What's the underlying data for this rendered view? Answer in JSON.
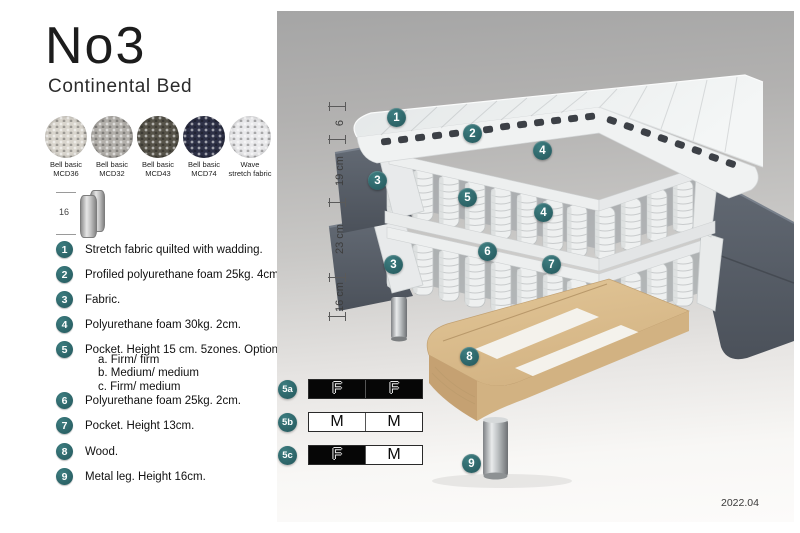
{
  "header": {
    "title": "No3",
    "subtitle": "Continental Bed"
  },
  "swatches": {
    "items": [
      {
        "line1": "Bell basic",
        "line2": "MCD36",
        "color": "#d9d5cd"
      },
      {
        "line1": "Bell basic",
        "line2": "MCD32",
        "color": "#b2afaa"
      },
      {
        "line1": "Bell basic",
        "line2": "MCD43",
        "color": "#565349"
      },
      {
        "line1": "Bell basic",
        "line2": "MCD74",
        "color": "#2e3147"
      },
      {
        "line1": "Wave",
        "line2": "stretch fabric",
        "color": "#e9e9eb"
      }
    ]
  },
  "leg_icon": {
    "height_label": "16"
  },
  "spec_list": {
    "items": [
      {
        "num": "1",
        "text": "Stretch fabric quilted with wadding."
      },
      {
        "num": "2",
        "text": "Profiled polyurethane foam 25kg. 4cm."
      },
      {
        "num": "3",
        "text": "Fabric."
      },
      {
        "num": "4",
        "text": "Polyurethane foam 30kg. 2cm."
      },
      {
        "num": "5",
        "text": "Pocket. Height 15 cm. 5zones. Option:",
        "options": [
          "a. Firm/ firm",
          "b. Medium/ medium",
          "c. Firm/ medium"
        ]
      },
      {
        "num": "6",
        "text": "Polyurethane foam 25kg. 2cm."
      },
      {
        "num": "7",
        "text": "Pocket. Height 13cm."
      },
      {
        "num": "8",
        "text": "Wood."
      },
      {
        "num": "9",
        "text": "Metal leg. Height 16cm."
      }
    ]
  },
  "diagram": {
    "accent_color": "#2e6a6e",
    "dimensions": [
      "6",
      "19 cm",
      "23 cm",
      "16 cm"
    ],
    "callouts": [
      "1",
      "2",
      "4",
      "3",
      "5",
      "4",
      "6",
      "7",
      "3",
      "8",
      "9"
    ]
  },
  "firmness": {
    "rows": [
      {
        "id": "5a",
        "cells": [
          {
            "letter": "F",
            "style": "dark"
          },
          {
            "letter": "F",
            "style": "dark"
          }
        ]
      },
      {
        "id": "5b",
        "cells": [
          {
            "letter": "M",
            "style": "light"
          },
          {
            "letter": "M",
            "style": "light"
          }
        ]
      },
      {
        "id": "5c",
        "cells": [
          {
            "letter": "F",
            "style": "dark"
          },
          {
            "letter": "M",
            "style": "light"
          }
        ]
      }
    ]
  },
  "footer": {
    "version": "2022.04"
  }
}
